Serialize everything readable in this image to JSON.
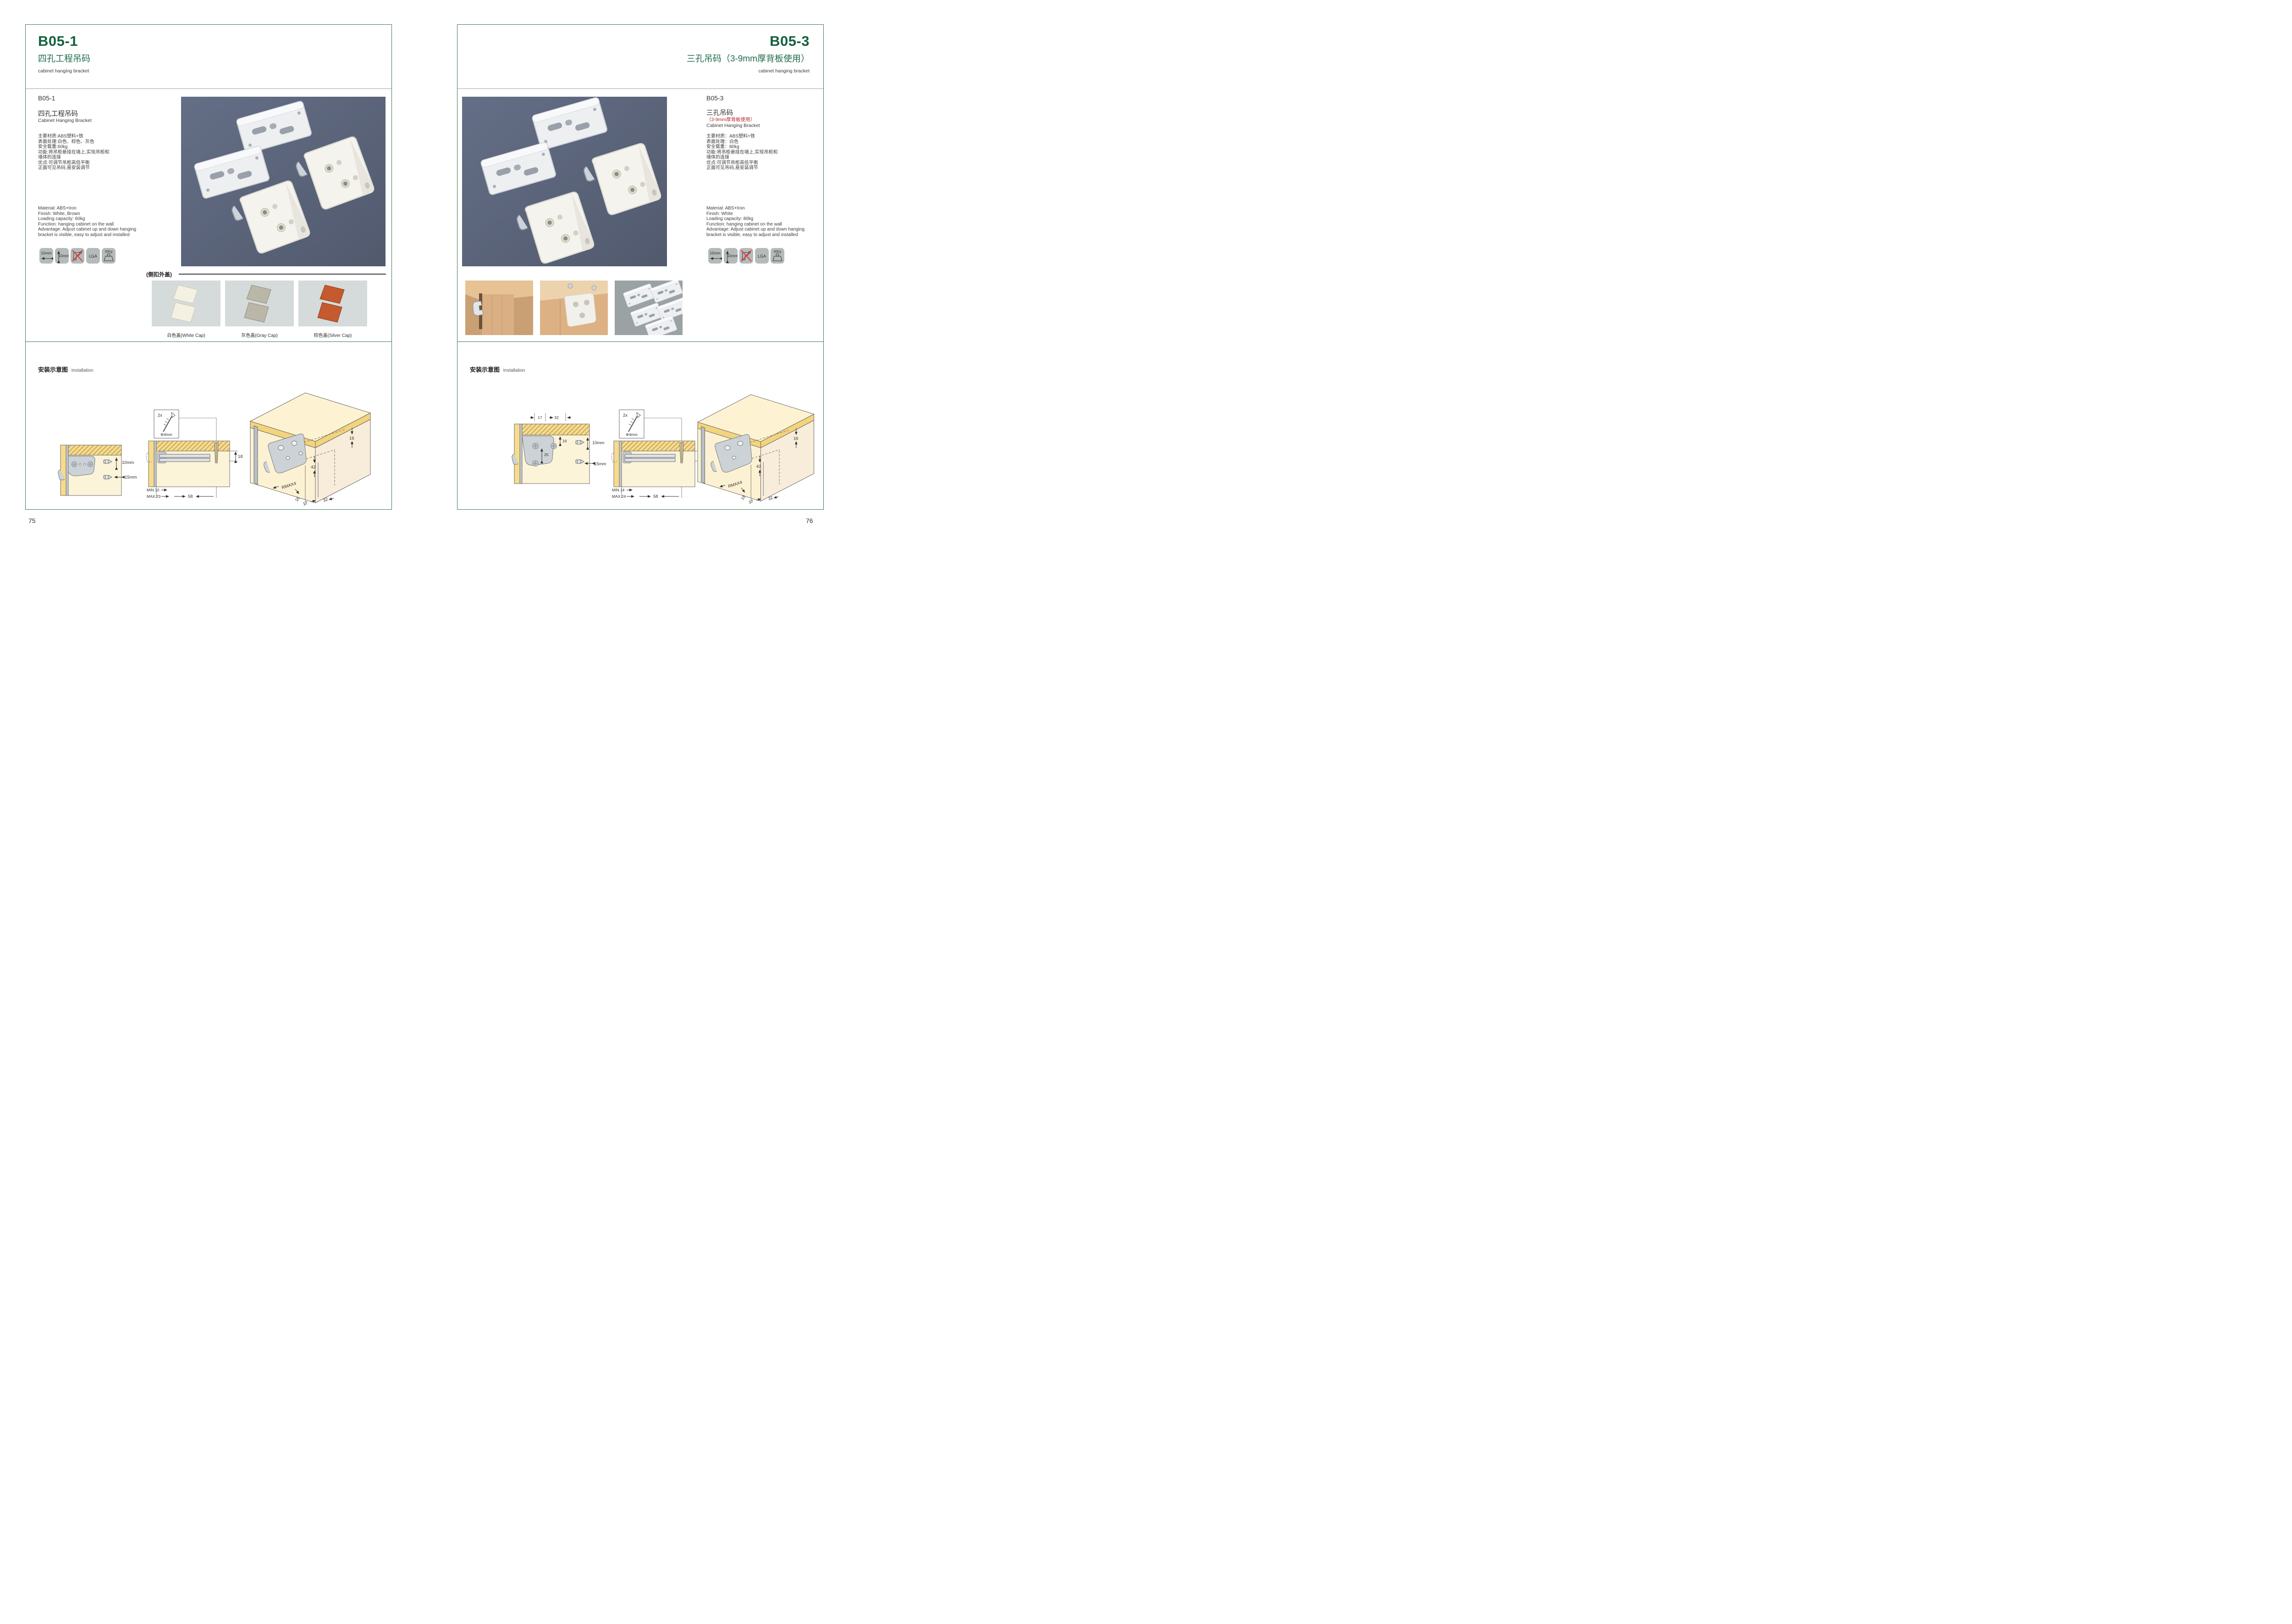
{
  "colors": {
    "accent_green": "#14613e",
    "title_green": "#1d6b49",
    "accent_red": "#b5272d",
    "frame_border": "#35795b",
    "photo_bg": "#5a6378",
    "icon_bg": "#b5babb",
    "cap_panel_bg": "#d5dadb"
  },
  "left": {
    "header": {
      "code": "B05-1",
      "title_cn": "四孔工程吊码",
      "title_en": "cabinet hanging bracket"
    },
    "product": {
      "code": "B05-1",
      "name_cn": "四孔工程吊码",
      "name_en": "Cabinet Hanging Bracket",
      "specs_cn": [
        "主要材质:ABS塑料+铁",
        "表面处理:白色、棕色、灰色",
        "安全载重:60kg",
        "功能:将吊柜悬挂在墙上,实现吊柜和",
        "墙体的连接",
        "优点:可调节吊柜高低平衡",
        "正面可见吊码,易安装调节"
      ],
      "specs_en": [
        "Material: ABS+Iron",
        "Finish: White, Brown",
        "Loading capacity: 60kg",
        "Function: hanging cabinet on the wall",
        "Advantage: Adjust cabinet up and down hanging",
        "bracket is visible, easy to adjust and installed"
      ]
    },
    "icons": [
      {
        "label": "15mm"
      },
      {
        "label": "10mm"
      },
      {
        "name": "no-drill-icon"
      },
      {
        "label": "LGA"
      },
      {
        "label": "60Kg"
      }
    ],
    "caps": {
      "label": "(侧扣外盖)",
      "items": [
        {
          "caption": "白色盖(White Cap)",
          "fill": "#f5f1e2",
          "edge": "#d9d3bc"
        },
        {
          "caption": "灰色盖(Gray Cap)",
          "fill": "#bab7a8",
          "edge": "#96927d"
        },
        {
          "caption": "棕色盖(Silver Cap)",
          "fill": "#c45a2e",
          "edge": "#8e3c1c"
        }
      ]
    },
    "installation": {
      "title_cn": "安装示意图",
      "title_en": "Installation",
      "d1": {
        "v": "10mm",
        "h": "15mm"
      },
      "d2": {
        "qty": "2x",
        "dia": "Φ4mm",
        "min": "MIN.10",
        "max": "MAX.23",
        "depth": "58",
        "side": "18"
      },
      "d3": {
        "edge": "16",
        "height": "42",
        "radius": "RMAX4",
        "corner": "16",
        "p1": "17",
        "p2": "32"
      }
    },
    "page_number": "75"
  },
  "right": {
    "header": {
      "code": "B05-3",
      "title_cn": "三孔吊码（3-9mm厚背板使用）",
      "title_en": "cabinet hanging bracket"
    },
    "product": {
      "code": "B05-3",
      "name_cn": "三孔吊码",
      "name_sub_red": "（3-9mm厚背板使用）",
      "name_en": "Cabinet Hanging Bracket",
      "specs_cn": [
        "主要材质：ABS塑料+铁",
        "表面处理：白色",
        "安全载重：80kg",
        "功能:将吊柜悬挂在墙上,实现吊柜和",
        "墙体的连接",
        "优点:可调节吊柜高低平衡",
        "正面可见吊码,易安装调节"
      ],
      "specs_en": [
        "Material: ABS+Iron",
        "Finish: White",
        "Loading capacity: 80kg",
        "Function: hanging cabinet on the wall",
        "Advantage: Adjust cabinet up and down hanging",
        "bracket is visible, easy to adjust and installed"
      ]
    },
    "icons": [
      {
        "label": "15mm"
      },
      {
        "label": "10mm"
      },
      {
        "name": "no-drill-icon"
      },
      {
        "label": "LGA"
      },
      {
        "label": "80Kg"
      }
    ],
    "installation": {
      "title_cn": "安装示意图",
      "title_en": "Installation",
      "d1": {
        "t1": "17",
        "t2": "32",
        "hole": "16",
        "gap": "25",
        "v": "10mm",
        "h": "15mm"
      },
      "d2": {
        "qty": "2x",
        "dia": "Φ4mm",
        "min": "MIN.14",
        "max": "MAX.24",
        "depth": "58",
        "side": "18"
      },
      "d3": {
        "edge": "16",
        "height": "42",
        "radius": "RMAX4",
        "corner": "18",
        "p1": "17",
        "p2": "32"
      }
    },
    "page_number": "76"
  }
}
